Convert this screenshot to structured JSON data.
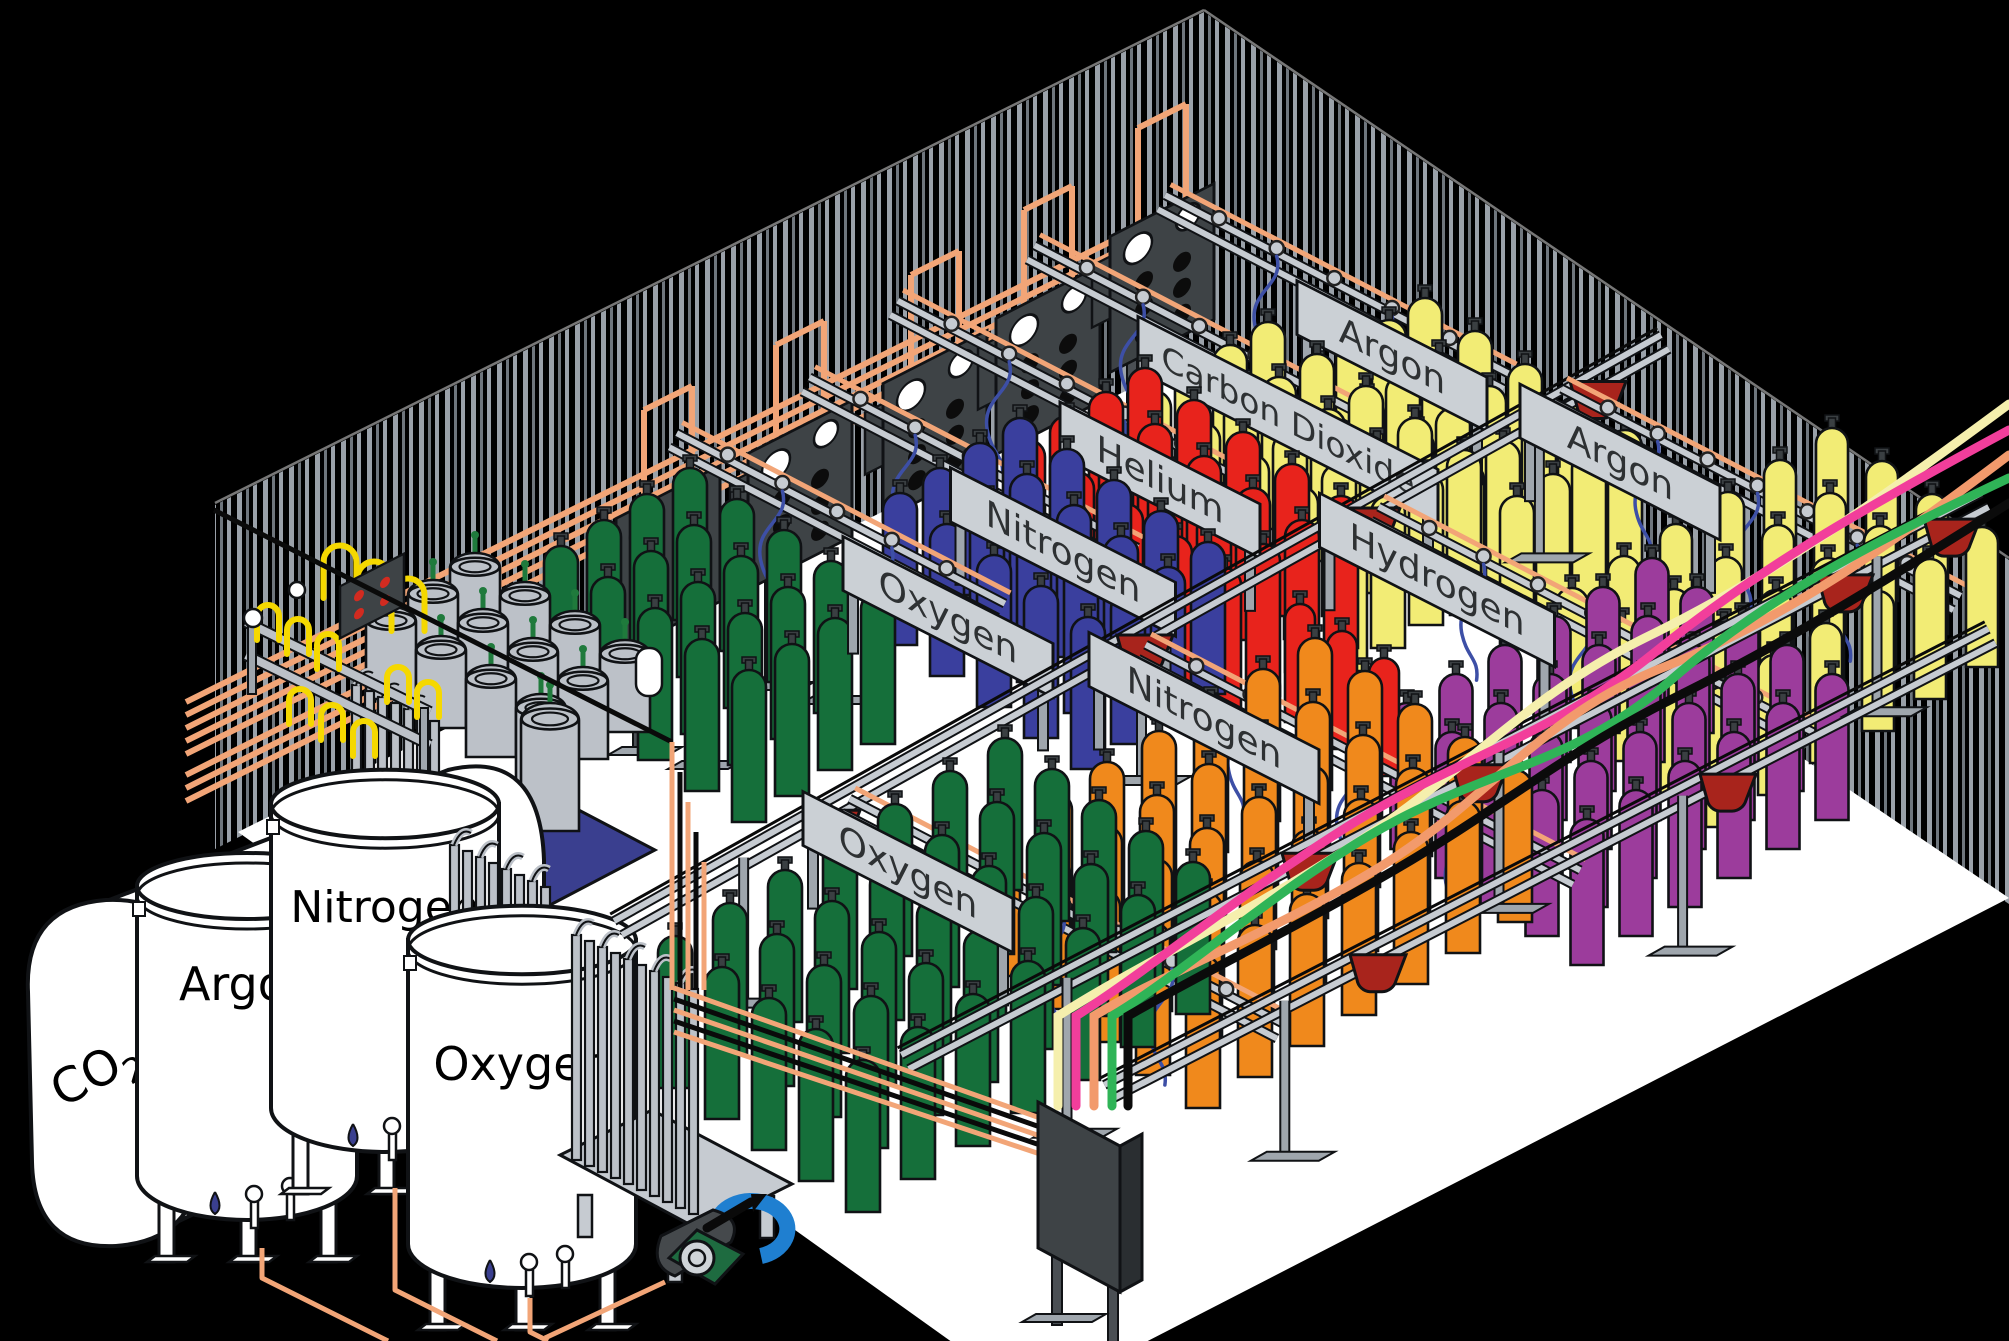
{
  "scene": {
    "title": "Industrial gas cylinder filling plant — isometric cutaway",
    "width": 2009,
    "height": 1341
  },
  "colors": {
    "background": "#000000",
    "floor": "#FFFFFF",
    "stripe_light": "#9AA1A9",
    "stripe_mid": "#6F767D",
    "outline": "#101215",
    "copper": "#F2A577",
    "rail_gray": "#C6CBD1",
    "plate_fill": "#CBD0D5",
    "plate_text": "#2E3133",
    "pigtail_blue": "#3D4FA6",
    "cart_maroon": "#A8241C",
    "panel_dark": "#3E4346",
    "panel_side": "#2A2E31",
    "tank_white": "#FFFFFF",
    "dewar_gray": "#BCC1C8",
    "valve_green": "#1F7A3C",
    "pallet_blue": "#3A3F8F",
    "yellow_pigtail": "#F5D800",
    "gauge_white": "#FFFFFF",
    "dot_red": "#D22B20",
    "hose_cream": "#F5EFAD",
    "hose_pink": "#F23E9B",
    "hose_salmon": "#F29A6C",
    "hose_green": "#2FB457",
    "hose_black": "#0B0B0B",
    "compressor_green": "#1E6B40",
    "compressor_blue": "#1F7FD0",
    "compressor_gray": "#45494C",
    "gas_oxygen": "#156F3A",
    "gas_nitrogen_back": "#3A3F9E",
    "gas_helium": "#E8231C",
    "gas_carbon_dioxide": "#F2EC75",
    "gas_argon": "#F2EC75",
    "gas_nitrogen_front": "#F0891C",
    "gas_hydrogen": "#9C3C9C"
  },
  "storage_tanks": [
    {
      "id": "co2",
      "label": "CO",
      "subscript": "2",
      "type": "horizontal"
    },
    {
      "id": "argon",
      "label": "Argon",
      "type": "vertical",
      "cx": 247,
      "top": 880,
      "bottom": 1210,
      "rx": 110,
      "labelY": 1000,
      "fs": 46
    },
    {
      "id": "nitrogen",
      "label": "Nitrogen",
      "type": "vertical",
      "cx": 385,
      "top": 798,
      "bottom": 1142,
      "rx": 114,
      "labelY": 922,
      "fs": 44
    },
    {
      "id": "oxygen",
      "label": "Oxygen",
      "type": "vertical",
      "cx": 522,
      "top": 934,
      "bottom": 1278,
      "rx": 114,
      "labelY": 1080,
      "fs": 46
    }
  ],
  "cylinder_groups": [
    {
      "id": "argon-back",
      "gas": "Argon",
      "color": "#F2EC75",
      "T": [
        1425,
        298
      ],
      "sv": [
        50,
        33
      ],
      "nv": 5,
      "su": [
        -36,
        22
      ],
      "nu": 4,
      "w": 34,
      "h": 152,
      "layer": "back"
    },
    {
      "id": "carbon-dioxide",
      "gas": "Carbon Dioxide",
      "color": "#F2EC75",
      "T": [
        1268,
        322
      ],
      "sv": [
        49,
        32
      ],
      "nv": 5,
      "su": [
        -38,
        23
      ],
      "nu": 4,
      "w": 34,
      "h": 152,
      "layer": "back"
    },
    {
      "id": "helium",
      "gas": "Helium",
      "color": "#E8231C",
      "T": [
        1145,
        368
      ],
      "sv": [
        49,
        32
      ],
      "nv": 5,
      "su": [
        -39,
        24
      ],
      "nu": 4,
      "w": 34,
      "h": 152,
      "layer": "back"
    },
    {
      "id": "nitrogen-back",
      "gas": "Nitrogen",
      "color": "#3A3F9E",
      "T": [
        1020,
        418
      ],
      "sv": [
        47,
        31
      ],
      "nv": 5,
      "su": [
        -40,
        25
      ],
      "nu": 4,
      "w": 34,
      "h": 152,
      "layer": "back"
    },
    {
      "id": "oxygen-back",
      "gas": "Oxygen",
      "color": "#156F3A",
      "T": [
        690,
        468
      ],
      "sv": [
        47,
        31
      ],
      "nv": 5,
      "su": [
        -43,
        26
      ],
      "nu": 4,
      "w": 34,
      "h": 152,
      "layer": "back"
    },
    {
      "id": "argon-right",
      "gas": "Argon",
      "color": "#F2EC75",
      "T": [
        1832,
        428
      ],
      "sv": [
        50,
        33
      ],
      "nv": 4,
      "su": [
        -52,
        32
      ],
      "nu": 6,
      "w": 32,
      "h": 140,
      "layer": "front"
    },
    {
      "id": "hydrogen",
      "gas": "Hydrogen",
      "color": "#9C3C9C",
      "T": [
        1652,
        558
      ],
      "sv": [
        45,
        29
      ],
      "nv": 5,
      "su": [
        -49,
        29
      ],
      "nu": 6,
      "w": 33,
      "h": 146,
      "layer": "front"
    },
    {
      "id": "helium-front",
      "gas": "Helium",
      "color": "#E8231C",
      "T": [
        1300,
        604
      ],
      "sv": [
        42,
        27
      ],
      "nv": 3,
      "su": [
        -40,
        24
      ],
      "nu": 1,
      "w": 30,
      "h": 118,
      "layer": "front"
    },
    {
      "id": "nitrogen-front",
      "gas": "Nitrogen",
      "color": "#F0891C",
      "T": [
        1315,
        638
      ],
      "sv": [
        50,
        33
      ],
      "nv": 5,
      "su": [
        -52,
        31
      ],
      "nu": 7,
      "w": 34,
      "h": 152,
      "layer": "front"
    },
    {
      "id": "oxygen-front",
      "gas": "Oxygen",
      "color": "#156F3A",
      "T": [
        1005,
        738
      ],
      "sv": [
        47,
        31
      ],
      "nv": 5,
      "su": [
        -55,
        33
      ],
      "nu": 7,
      "w": 34,
      "h": 152,
      "layer": "front"
    }
  ],
  "rail_labels": [
    {
      "id": "argon-back",
      "text": "Argon",
      "x": 1392,
      "y": 356,
      "w": 190,
      "back": 260,
      "fwd": 130
    },
    {
      "id": "carbon-dioxide",
      "text": "Carbon Dioxide",
      "x": 1288,
      "y": 420,
      "w": 300,
      "back": 290,
      "fwd": 90
    },
    {
      "id": "helium",
      "text": "Helium",
      "x": 1160,
      "y": 480,
      "w": 200,
      "back": 300,
      "fwd": 90
    },
    {
      "id": "nitrogen-back",
      "text": "Nitrogen",
      "x": 1063,
      "y": 552,
      "w": 225,
      "back": 290,
      "fwd": 80
    },
    {
      "id": "oxygen-back",
      "text": "Oxygen",
      "x": 948,
      "y": 617,
      "w": 210,
      "back": 310,
      "fwd": 60
    },
    {
      "id": "argon-right",
      "text": "Argon",
      "x": 1620,
      "y": 462,
      "w": 200,
      "back": 70,
      "fwd": 380
    },
    {
      "id": "hydrogen",
      "text": "Hydrogen",
      "x": 1437,
      "y": 580,
      "w": 235,
      "back": 70,
      "fwd": 420
    },
    {
      "id": "nitrogen-front",
      "text": "Nitrogen",
      "x": 1204,
      "y": 718,
      "w": 230,
      "back": 70,
      "fwd": 420
    },
    {
      "id": "oxygen-front",
      "text": "Oxygen",
      "x": 908,
      "y": 872,
      "w": 210,
      "back": 70,
      "fwd": 420
    }
  ],
  "transfer_rails": [
    {
      "id": "u1",
      "a": [
        618,
        928
      ],
      "b": [
        1665,
        342
      ],
      "carts": [
        832,
        1145,
        1372,
        1598
      ],
      "posts": [
        0.12,
        0.5,
        0.88
      ],
      "layer": "mid"
    },
    {
      "id": "u2",
      "a": [
        905,
        1062
      ],
      "b": [
        1985,
        500
      ],
      "carts": [
        1310,
        1480,
        1845,
        1952
      ],
      "posts": [
        0.15,
        0.55,
        0.9
      ],
      "layer": "front"
    },
    {
      "id": "u3",
      "a": [
        1108,
        1092
      ],
      "b": [
        1992,
        636
      ],
      "carts": [
        1378,
        1728
      ],
      "posts": [
        0.2,
        0.65
      ],
      "layer": "front"
    }
  ],
  "supply_hoses": [
    {
      "id": "cream",
      "color": "#F5EFAD",
      "x": 1058,
      "endY": 404,
      "phase": 1
    },
    {
      "id": "pink",
      "color": "#F23E9B",
      "x": 1076,
      "endY": 430,
      "phase": -1
    },
    {
      "id": "salmon",
      "color": "#F29A6C",
      "x": 1094,
      "endY": 455,
      "phase": 1.4
    },
    {
      "id": "green",
      "color": "#2FB457",
      "x": 1112,
      "endY": 478,
      "phase": -1.4
    },
    {
      "id": "black",
      "color": "#0B0B0B",
      "x": 1128,
      "endY": 503,
      "phase": 0.5
    }
  ],
  "manifold_panels": [
    [
      668,
      560
    ],
    [
      800,
      495
    ],
    [
      935,
      425
    ],
    [
      1048,
      360
    ],
    [
      1162,
      278
    ]
  ],
  "dewar_cluster": {
    "origin": [
      475,
      553
    ],
    "sv": [
      50,
      29
    ],
    "nv": 4,
    "su": [
      -42,
      27
    ],
    "nu": 3,
    "w": 50,
    "h": 92
  },
  "pallet_dewar": {
    "x": 550,
    "y": 703,
    "w": 58,
    "h": 128
  },
  "vaporizers": [
    {
      "x": 352,
      "y": 800,
      "n": 7,
      "h": 115,
      "platform": false
    },
    {
      "x": 450,
      "y": 1005,
      "n": 8,
      "h": 160,
      "platform": false
    },
    {
      "x": 572,
      "y": 1160,
      "n": 10,
      "h": 225,
      "platform": true
    }
  ]
}
